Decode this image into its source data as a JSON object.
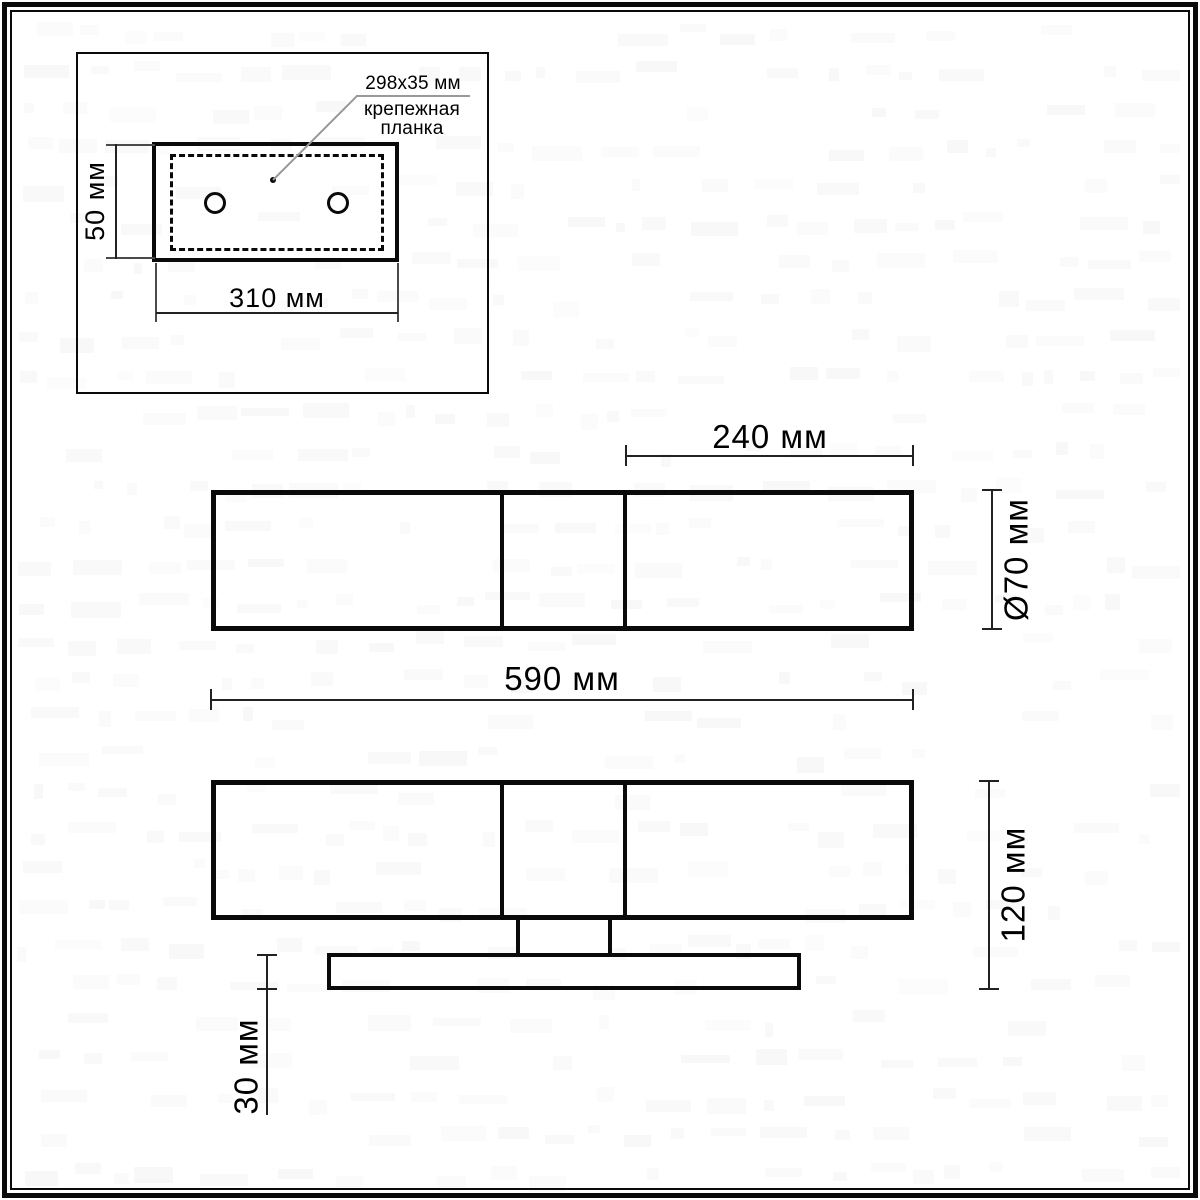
{
  "colors": {
    "line": "#0a0a0a",
    "dim": "#222222",
    "ext": "#4a4a4a",
    "leader": "#999999"
  },
  "inset": {
    "callout_size": "298x35 мм",
    "callout_name_line1": "крепежная",
    "callout_name_line2": "планка",
    "dim_height": "50 мм",
    "dim_width": "310 мм"
  },
  "front_view": {
    "dim_segment": "240 мм",
    "dim_diameter": "Ø70 мм",
    "dim_length": "590 мм"
  },
  "side_view": {
    "dim_height": "120 мм",
    "dim_base_height": "30 мм"
  }
}
